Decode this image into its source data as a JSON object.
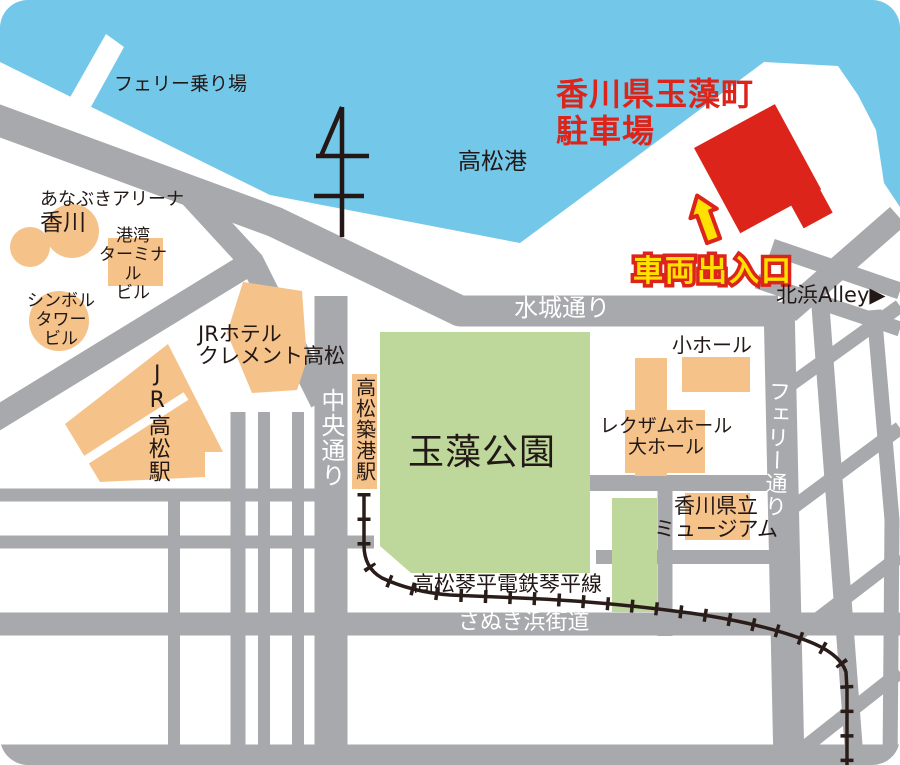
{
  "labels": {
    "title_line1": "香川県玉藻町",
    "title_line2": "駐車場",
    "vehicle_entrance": "車両出入口",
    "port": "高松港",
    "ferry_boarding": "フェリー乗り場",
    "anabuki_arena_line1": "あなぶきアリーナ",
    "anabuki_arena_line2": "香川",
    "port_terminal_line1": "港湾",
    "port_terminal_line2": "ターミナル",
    "port_terminal_line3": "ビル",
    "symbol_tower_line1": "シンボル",
    "symbol_tower_line2": "タワー",
    "symbol_tower_line3": "ビル",
    "jr_hotel_line1": "JRホテル",
    "jr_hotel_line2": "クレメント高松",
    "jr_takamatsu_station": "JR高松駅",
    "chuo_dori": "中央通り",
    "takamatsu_chikko_station": "高松築港駅",
    "tamamo_park": "玉藻公園",
    "mizuki_dori": "水城通り",
    "small_hall": "小ホール",
    "rexxam_hall_line1": "レクザムホール",
    "rexxam_hall_line2": "大ホール",
    "ferry_dori": "フェリー通り",
    "kagawa_museum_line1": "香川県立",
    "kagawa_museum_line2": "ミュージアム",
    "kitahama_alley": "北浜Alley▶",
    "kotohira_railway_line": "高松琴平電鉄琴平線",
    "sanuki_hama_kaido": "さぬき浜街道"
  },
  "colors": {
    "water": "#73c7e8",
    "road": "#a8a9ac",
    "building": "#f5c289",
    "park": "#bed79b",
    "accent_red": "#dc241a",
    "accent_yellow": "#ffe100",
    "railway": "#2a1d19",
    "text": "#221815"
  }
}
